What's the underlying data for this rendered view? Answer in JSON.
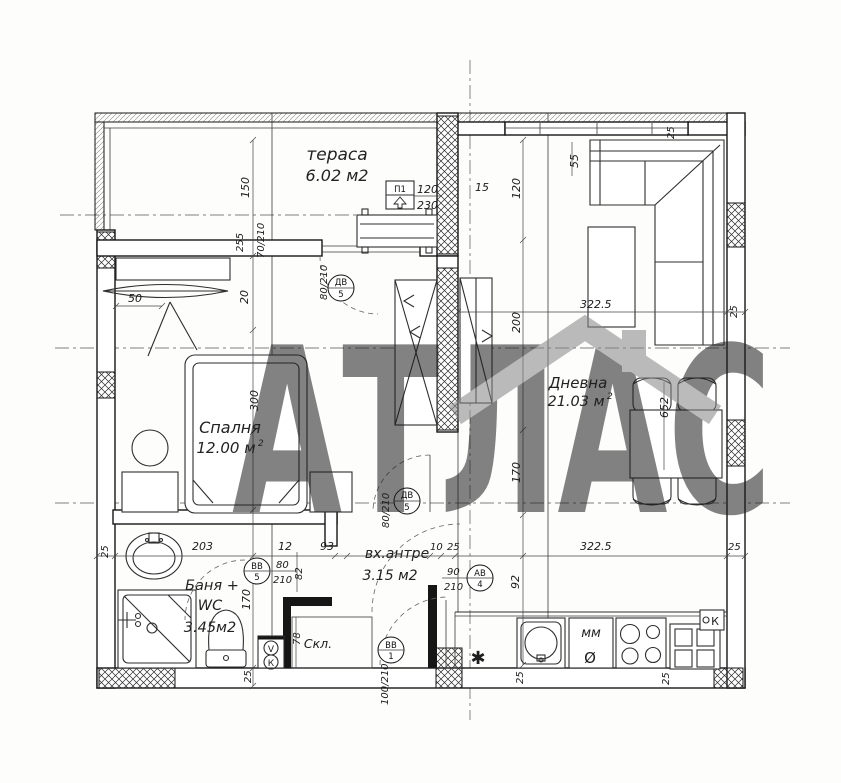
{
  "watermark": {
    "brand": "АТЛАС"
  },
  "rooms": {
    "terrace": {
      "name": "тераса",
      "area": "6.02 м2"
    },
    "bedroom": {
      "name": "Спалня",
      "area": "12.00 м",
      "area_sup": "2"
    },
    "living": {
      "name": "Дневна",
      "area": "21.03 м",
      "area_sup": "2"
    },
    "bathroom": {
      "name_line1": "Баня +",
      "name_line2": "WC",
      "area": "3.45м2"
    },
    "hall": {
      "name": "вх.антре",
      "area": "3.15 м2"
    },
    "storage": {
      "name": "Скл."
    }
  },
  "openings": {
    "window_terrace": {
      "code": "П1",
      "width": "120",
      "height": "230"
    },
    "door_balcony": {
      "code": "ДВ",
      "index": "5",
      "size": "80/210"
    },
    "door_bedroom": {
      "code": "ДВ",
      "index": "5",
      "size": "80/210"
    },
    "door_bathroom": {
      "code": "ВВ",
      "index": "5",
      "width": "80",
      "height": "210"
    },
    "door_living": {
      "code": "АВ",
      "index": "4",
      "width": "90",
      "height": "210"
    },
    "door_entrance": {
      "code": "ВВ",
      "index": "1",
      "size": "100/210"
    }
  },
  "dimensions": {
    "d10": "10",
    "d12": "12",
    "d15": "15",
    "d20": "20",
    "d25": "25",
    "d50": "50",
    "d55": "55",
    "d78": "78",
    "d82": "82",
    "d92": "92",
    "d93": "93",
    "d120": "120",
    "d150": "150",
    "d170": "170",
    "d200": "200",
    "d203": "203",
    "d255": "255",
    "d300": "300",
    "d322_5": "322.5",
    "d652": "652",
    "d70_210": "70/210"
  },
  "kitchen": {
    "label_mm": "мм",
    "symbol_diameter": "Ø",
    "symbol_star": "✱",
    "label_k": "К"
  },
  "shafts": {
    "vent": "V",
    "sewer": "К"
  }
}
